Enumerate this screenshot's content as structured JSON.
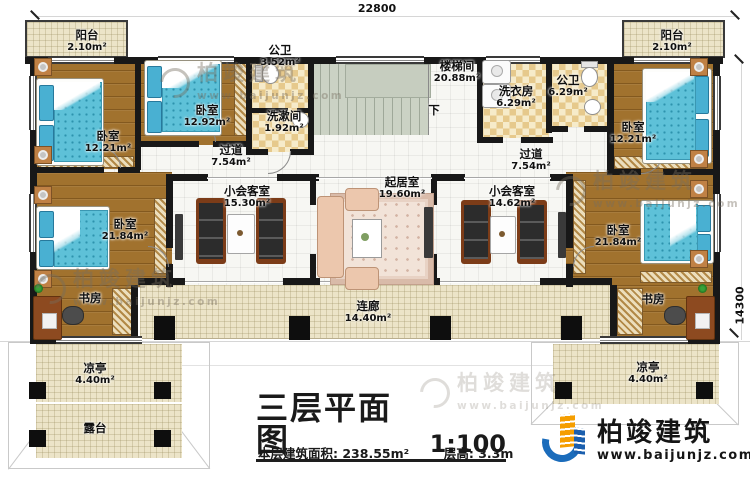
{
  "dimensions": {
    "top": "22800",
    "right": "14300"
  },
  "rooms": {
    "balcony_tl": {
      "name": "阳台",
      "area": "2.10m²"
    },
    "balcony_tr": {
      "name": "阳台",
      "area": "2.10m²"
    },
    "bedroom_tl": {
      "name": "卧室",
      "area": "12.21m²"
    },
    "bedroom_tm": {
      "name": "卧室",
      "area": "12.92m²"
    },
    "bath_small": {
      "name": "公卫",
      "area": "3.52m²"
    },
    "washroom": {
      "name": "洗漱间",
      "area": "1.92m²"
    },
    "stairwell": {
      "name": "楼梯间",
      "area": "20.88m²"
    },
    "stair_down": {
      "name": "下"
    },
    "laundry": {
      "name": "洗衣房",
      "area": "6.29m²"
    },
    "bath_right": {
      "name": "公卫",
      "area": "6.29m²"
    },
    "bedroom_tr": {
      "name": "卧室",
      "area": "12.21m²"
    },
    "hallway_left": {
      "name": "过道",
      "area": "7.54m²"
    },
    "hallway_right": {
      "name": "过道",
      "area": "7.54m²"
    },
    "meeting_left": {
      "name": "小会客室",
      "area": "15.30m²"
    },
    "living": {
      "name": "起居室",
      "area": "19.60m²"
    },
    "meeting_right": {
      "name": "小会客室",
      "area": "14.62m²"
    },
    "bedroom_l": {
      "name": "卧室",
      "area": "21.84m²"
    },
    "study_l": {
      "name": "书房"
    },
    "bedroom_r": {
      "name": "卧室",
      "area": "21.84m²"
    },
    "study_r": {
      "name": "书房"
    },
    "corridor": {
      "name": "连廊",
      "area": "14.40m²"
    },
    "pavilion_l": {
      "name": "凉亭",
      "area": "4.40m²"
    },
    "pavilion_r": {
      "name": "凉亭",
      "area": "4.40m²"
    },
    "terrace": {
      "name": "露台"
    }
  },
  "title": {
    "main": "三层平面图",
    "scale": "1:100",
    "area_label": "本层建筑面积:",
    "area_value": "238.55m²",
    "height_label": "层高:",
    "height_value": "3.3m"
  },
  "branding": {
    "company": "柏竣建筑",
    "website": "www.baijunjz.com"
  },
  "watermark": {
    "company": "柏竣建筑",
    "website": "www.baijunjz.com"
  },
  "colors": {
    "wall": "#181818",
    "wood_floor": "#A1722E",
    "bed_teal": "#5EC1D8",
    "checker_tan": "#E6C98C",
    "stair_green": "#CBD2C4",
    "cream_tile": "#ECE4C8",
    "brand_blue": "#1B6CBB",
    "brand_orange": "#F59E00"
  }
}
